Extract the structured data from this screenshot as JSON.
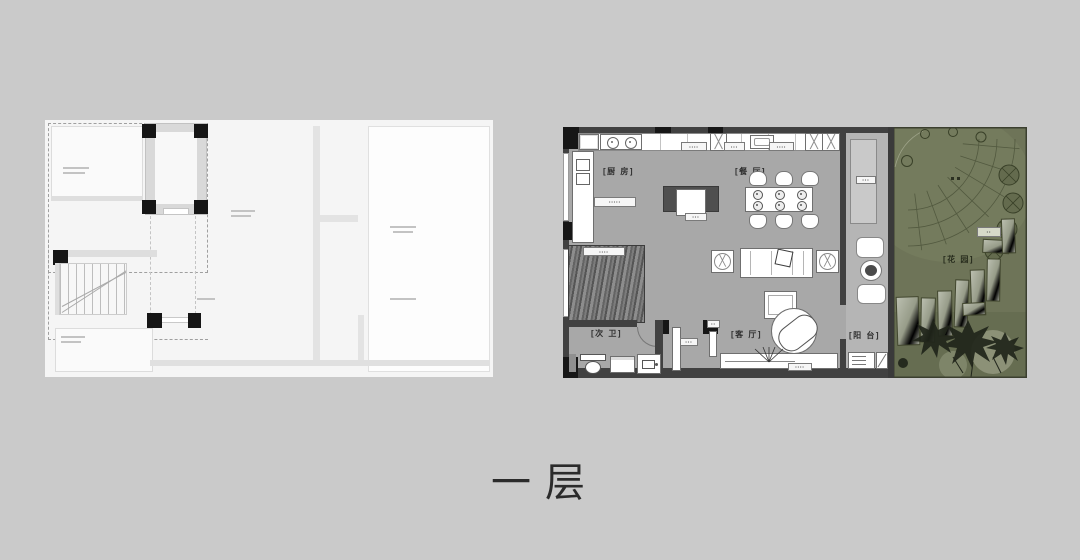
{
  "title": "一层",
  "rooms": {
    "kitchen": "[厨 房]",
    "dining": "[餐 厅]",
    "living": "[客 厅]",
    "bath": "[次 卫]",
    "balcony": "[阳 台]",
    "garden": "[花 园]"
  },
  "chips": {
    "c1": "••••",
    "c2": "•••",
    "c3": "••••",
    "c4": "•••••",
    "c5": "•••",
    "c6": "••••",
    "c7": "•••",
    "c8": "••",
    "c9": "••••",
    "c10": "•••",
    "c11": "••"
  },
  "colors": {
    "background": "#cacaca",
    "floor_gray": "#a8a8a8",
    "wall_dark": "#414141",
    "column_black": "#161616",
    "balcony_gray": "#b5b5b5",
    "garden_olive": "#6e7458",
    "lineplan_white": "#f5f5f5"
  }
}
